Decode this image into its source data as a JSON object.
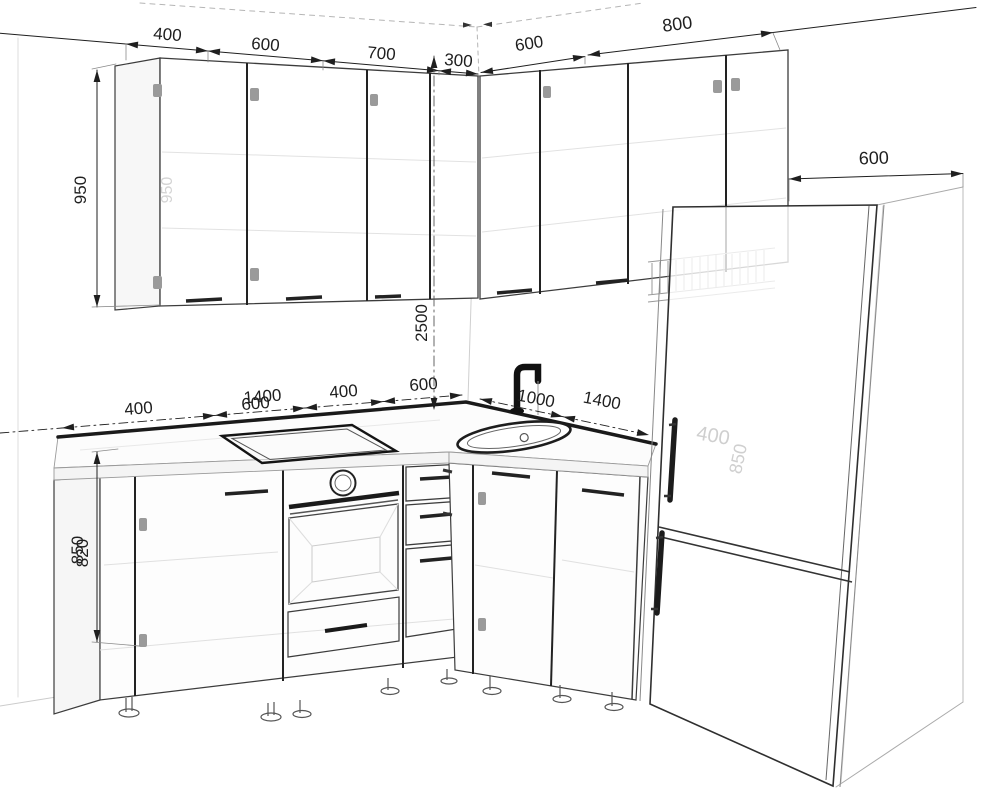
{
  "drawing": {
    "kind": "kitchen-3d-wireframe"
  },
  "dims": {
    "wall_left": [
      "400",
      "600",
      "700",
      "300"
    ],
    "wall_right": [
      "600",
      "800"
    ],
    "tall_unit_depth": "600",
    "wall_cabinet_height": "950",
    "room_height": "2500",
    "base_height_overlap": [
      "850",
      "820"
    ],
    "counter_left": [
      "400",
      "600",
      "1400",
      "400",
      "600"
    ],
    "counter_right": [
      "1000",
      "1400"
    ],
    "faded": {
      "wall_cabinet": "950",
      "tall_a": "400",
      "tall_b": "850"
    }
  },
  "colors": {
    "ink": "#1f1f1f",
    "line": "#3c3c3c",
    "faint": "#dddddd",
    "faded_text": "#cfcfcf",
    "counter_band": "#1a1a1a",
    "background": "#ffffff"
  }
}
